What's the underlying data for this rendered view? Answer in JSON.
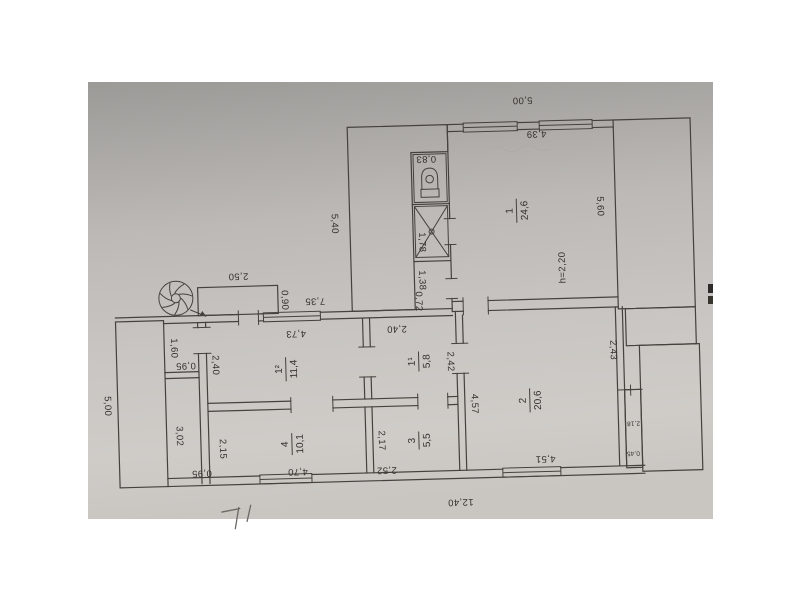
{
  "page": {
    "background": "#ffffff"
  },
  "photo": {
    "paper_top_color": "#9c9a97",
    "paper_mid_color": "#c3c0bd",
    "paper_bottom_color": "#cdcac6",
    "line_color": "#45423e",
    "text_color": "#33312e"
  },
  "rooms": [
    {
      "number": "1",
      "area": "24,6"
    },
    {
      "number": "1¹",
      "area": "5,8"
    },
    {
      "number": "1²",
      "area": "11,4"
    },
    {
      "number": "2",
      "area": "20,6"
    },
    {
      "number": "3",
      "area": "5,5"
    },
    {
      "number": "4",
      "area": "10,1"
    }
  ],
  "dims": {
    "top_5_00": "5,00",
    "room1_4_39": "4,39",
    "wc_0_83": "0,83",
    "shower_1_78": "1,78",
    "lobby_1_38": "1,38",
    "lobby_0_72": "0,72",
    "left_5_40": "5,40",
    "room1_5_60": "5,60",
    "height_note": "h=2,20",
    "porch_2_50": "2,50",
    "porch_0_90": "0,90",
    "mid_7_35": "7,35",
    "pantry_1_60": "1,60",
    "pantry_0_95": "0,95",
    "room12_2_40": "2,40",
    "room12_4_73": "4,73",
    "room11_2_40": "2,40",
    "room11_2_42": "2,42",
    "corridor_3_02": "3,02",
    "corridor_0_95": "0,95",
    "room4_2_15": "2,15",
    "room4_4_70": "4,70",
    "room3_2_17": "2,17",
    "room3_2_52": "2,52",
    "room2_4_57": "4,57",
    "room2_4_51": "4,51",
    "right_2_43": "2,43",
    "strip_2_18": "2,18",
    "strip_0_45": "0,45",
    "bottom_12_40": "12,40",
    "left_5_00": "5,00"
  }
}
